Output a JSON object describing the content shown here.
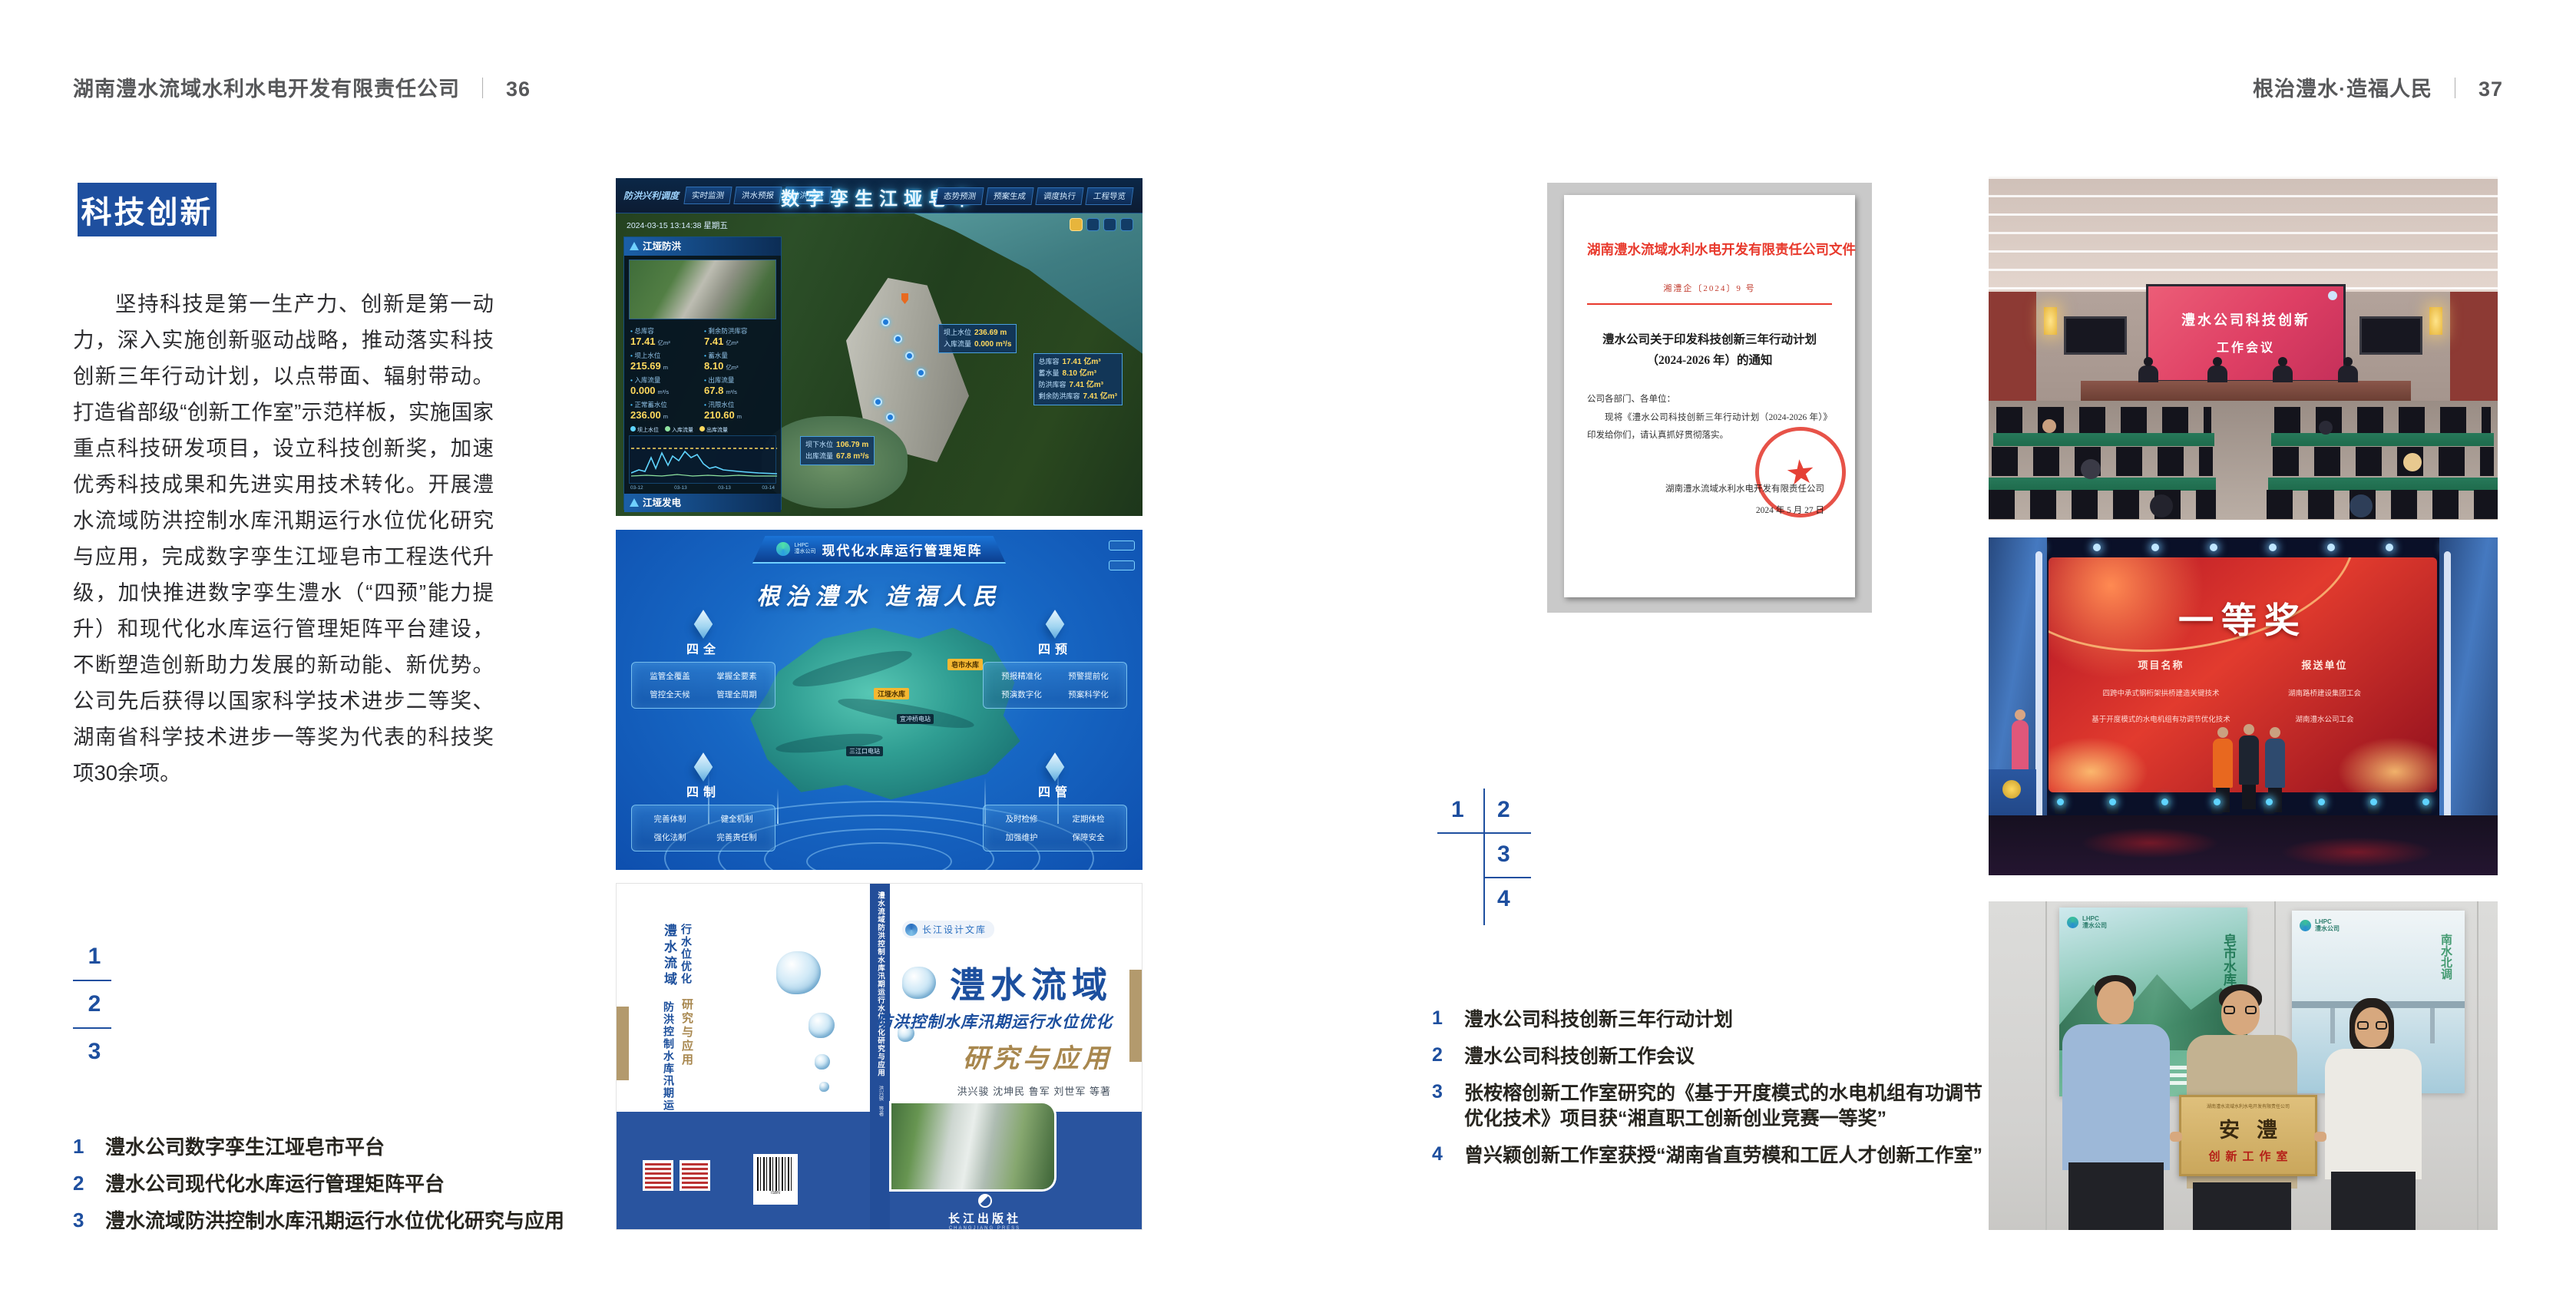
{
  "colors": {
    "accent_blue": "#1e4f9f",
    "document_red": "#e8392c",
    "book_blue": "#29549f",
    "gold": "#a8874e",
    "screen_pink": "#de3f64",
    "award_red": "#c01a26",
    "desk_green": "#1e6b4c",
    "plaque_gold": "#d2af6a"
  },
  "left_page": {
    "header": {
      "company": "湖南澧水流域水利水电开发有限责任公司",
      "divider": "｜",
      "page_number": "36"
    },
    "section_badge": "科技创新",
    "body_paragraph": "坚持科技是第一生产力、创新是第一动力，深入实施创新驱动战略，推动落实科技创新三年行动计划，以点带面、辐射带动。打造省部级“创新工作室”示范样板，实施国家重点科技研发项目，设立科技创新奖，加速优秀科技成果和先进实用技术转化。开展澧水流域防洪控制水库汛期运行水位优化研究与应用，完成数字孪生江垭皂市工程迭代升级，加快推进数字孪生澧水（“四预”能力提升）和现代化水库运行管理矩阵平台建设，不断塑造创新助力发展的新动能、新优势。公司先后获得以国家科学技术进步二等奖、湖南省科学技术进步一等奖为代表的科技奖项30余项。",
    "figure_index": [
      "1",
      "2",
      "3"
    ],
    "captions": [
      {
        "num": "1",
        "text": "澧水公司数字孪生江垭皂市平台"
      },
      {
        "num": "2",
        "text": "澧水公司现代化水库运行管理矩阵平台"
      },
      {
        "num": "3",
        "text": "澧水流域防洪控制水库汛期运行水位优化研究与应用"
      }
    ]
  },
  "right_page": {
    "header": {
      "title": "根治澧水·造福人民",
      "divider": "｜",
      "page_number": "37"
    },
    "figure_index": [
      "1",
      "2",
      "3",
      "4"
    ],
    "captions": [
      {
        "num": "1",
        "text": "澧水公司科技创新三年行动计划"
      },
      {
        "num": "2",
        "text": "澧水公司科技创新工作会议"
      },
      {
        "num": "3",
        "text": "张桉榕创新工作室研究的《基于开度模式的水电机组有功调节优化技术》项目获“湘直职工创新创业竞赛一等奖”"
      },
      {
        "num": "4",
        "text": "曾兴颖创新工作室获授“湖南省直劳模和工匠人才创新工作室”"
      }
    ]
  },
  "dashboard": {
    "title": "数字孪生江垭皂市",
    "module_label": "防洪兴利调度",
    "tabs_left": [
      "实时监测",
      "洪水预报",
      "防洪预警"
    ],
    "tabs_right": [
      "态势预测",
      "预案生成",
      "调度执行",
      "工程导览"
    ],
    "timestamp": "2024-03-15 13:14:38 星期五",
    "panel_flood": {
      "title": "江垭防洪",
      "stats": [
        {
          "label": "总库容",
          "value": "17.41",
          "unit": "亿m³"
        },
        {
          "label": "剩余防洪库容",
          "value": "7.41",
          "unit": "亿m³"
        },
        {
          "label": "坝上水位",
          "value": "215.69",
          "unit": "m"
        },
        {
          "label": "蓄水量",
          "value": "8.10",
          "unit": "亿m³"
        },
        {
          "label": "入库流量",
          "value": "0.000",
          "unit": "m³/s"
        },
        {
          "label": "出库流量",
          "value": "67.8",
          "unit": "m³/s"
        },
        {
          "label": "正常蓄水位",
          "value": "236.00",
          "unit": "m"
        },
        {
          "label": "汛限水位",
          "value": "210.60",
          "unit": "m"
        }
      ],
      "legend": [
        "坝上水位",
        "入库流量",
        "出库流量"
      ],
      "chart_x": [
        "03-12",
        "03-13",
        "03-13",
        "03-14"
      ]
    },
    "panel_power": {
      "title": "江垭发电",
      "stats": [
        {
          "label": "年发电计划",
          "value": "6.3000",
          "unit": "亿度"
        },
        {
          "label": "年累计发电量",
          "value": "1.2907",
          "unit": "亿度"
        },
        {
          "label": "月累计发电量",
          "value": "3359.21",
          "unit": "万度"
        },
        {
          "label": "当前出力",
          "value": "0.00",
          "unit": "MW"
        }
      ],
      "units": [
        "1号机组",
        "2号机组",
        "3号机组"
      ]
    },
    "tag_upstream": {
      "l1": "坝上水位",
      "v1": "236.69 m",
      "l2": "入库流量",
      "v2": "0.000 m³/s"
    },
    "tag_capacity": {
      "l1": "总库容",
      "v1": "17.41 亿m³",
      "l2": "蓄水量",
      "v2": "8.10 亿m³",
      "l3": "防洪库容",
      "v3": "7.41 亿m³",
      "l4": "剩余防洪库容",
      "v4": "7.41 亿m³"
    },
    "tag_downstream": {
      "l1": "坝下水位",
      "v1": "106.79 m",
      "l2": "出库流量",
      "v2": "67.8 m³/s"
    }
  },
  "matrix": {
    "logo_line1": "LHPC",
    "logo_line2": "澧水公司",
    "title": "现代化水库运行管理矩阵",
    "slogan": "根治澧水 造福人民",
    "panels": [
      {
        "title": "四全",
        "items": [
          "监管全覆盖",
          "掌握全要素",
          "管控全天候",
          "管理全周期"
        ]
      },
      {
        "title": "四预",
        "items": [
          "预报精准化",
          "预警提前化",
          "预演数字化",
          "预案科学化"
        ]
      },
      {
        "title": "四制",
        "items": [
          "完善体制",
          "健全机制",
          "强化法制",
          "完善责任制"
        ]
      },
      {
        "title": "四管",
        "items": [
          "及时检修",
          "定期体检",
          "加强维护",
          "保障安全"
        ]
      }
    ],
    "markers": [
      "皂市水库",
      "江垭水库",
      "宜冲桥电站",
      "三江口电站"
    ]
  },
  "book": {
    "series_badge": "长江设计文库",
    "title_main": "澧水流域",
    "title_sub": "防洪控制水库汛期运行水位优化",
    "title_tail": "研究与应用",
    "authors": "洪兴骏 沈坤民 鲁军 刘世军 等著",
    "spine_title": "澧水流域防洪控制水库汛期运行水位优化研究与应用",
    "spine_authors": "洪兴骏 等著",
    "publisher": "长江出版社",
    "publisher_latin": "CHANGJIANG PRESS"
  },
  "document": {
    "org_header": "湖南澧水流域水利水电开发有限责任公司文件",
    "doc_number": "湘澧企〔2024〕9 号",
    "title_line1": "澧水公司关于印发科技创新三年行动计划",
    "title_line2": "（2024-2026 年）的通知",
    "salutation": "公司各部门、各单位：",
    "body": "现将《澧水公司科技创新三年行动计划（2024-2026 年）》印发给你们，请认真抓好贯彻落实。",
    "signer": "湖南澧水流域水利水电开发有限责任公司",
    "date": "2024 年 5 月 27 日",
    "seal_star": "★"
  },
  "meeting": {
    "screen_line1": "澧水公司科技创新",
    "screen_line2": "工作会议"
  },
  "award": {
    "headline": "一等奖",
    "col_project": "项目名称",
    "col_org": "报送单位",
    "rows": [
      {
        "project": "四跨中承式钢桁架拱桥建造关键技术",
        "org": "湖南路桥建设集团工会"
      },
      {
        "project": "基于开度模式的水电机组有功调节优化技术",
        "org": "湖南澧水公司工会"
      }
    ]
  },
  "team": {
    "plaque_header": "湖南澧水流域水利水电开发有限责任公司",
    "plaque_title": "安澧",
    "plaque_sub": "创新工作室",
    "poster_left_text": "皂市水库",
    "poster_right_text": "南水北调",
    "poster_logo_line1": "LHPC",
    "poster_logo_line2": "澧水公司"
  }
}
